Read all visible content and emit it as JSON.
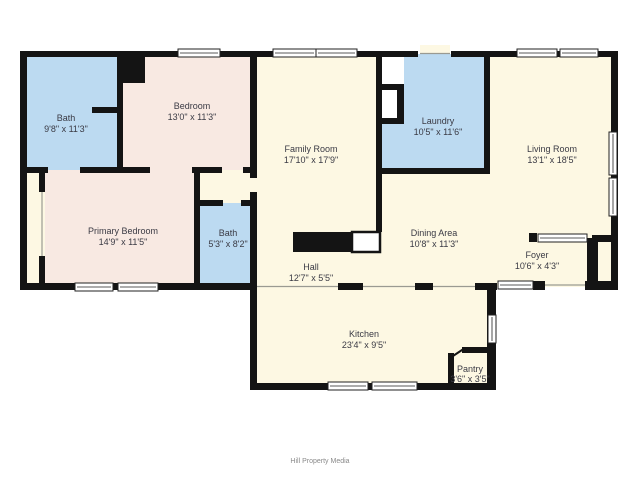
{
  "colors": {
    "wall": "#141414",
    "floor_cream": "#fdf8e3",
    "floor_pink": "#f8e9e2",
    "floor_blue": "#bcdaf1",
    "closet_white": "#ffffff",
    "label_text": "#3a3a44",
    "footer_text": "#8a8a8a"
  },
  "rooms": [
    {
      "id": "bath-upper",
      "name": "Bath",
      "dims": "9'8\" x 11'3\""
    },
    {
      "id": "bedroom",
      "name": "Bedroom",
      "dims": "13'0\" x 11'3\""
    },
    {
      "id": "family-room",
      "name": "Family Room",
      "dims": "17'10\" x 17'9\""
    },
    {
      "id": "laundry",
      "name": "Laundry",
      "dims": "10'5\" x 11'6\""
    },
    {
      "id": "living-room",
      "name": "Living Room",
      "dims": "13'1\" x 18'5\""
    },
    {
      "id": "primary-bedroom",
      "name": "Primary Bedroom",
      "dims": "14'9\" x 11'5\""
    },
    {
      "id": "bath-small",
      "name": "Bath",
      "dims": "5'3\" x 8'2\""
    },
    {
      "id": "dining-area",
      "name": "Dining Area",
      "dims": "10'8\" x 11'3\""
    },
    {
      "id": "hall",
      "name": "Hall",
      "dims": "12'7\" x 5'5\""
    },
    {
      "id": "foyer",
      "name": "Foyer",
      "dims": "10'6\" x 4'3\""
    },
    {
      "id": "kitchen",
      "name": "Kitchen",
      "dims": "23'4\" x 9'5\""
    },
    {
      "id": "pantry",
      "name": "Pantry",
      "dims": "3'6\" x 3'5\""
    }
  ],
  "footer": {
    "credit": "Hill Property Media"
  }
}
